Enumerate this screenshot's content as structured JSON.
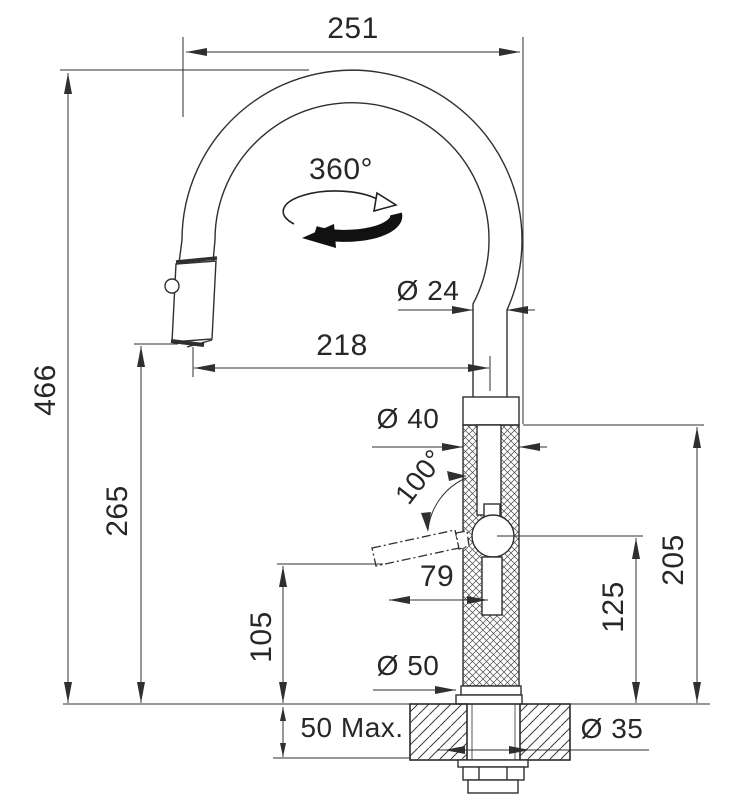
{
  "drawing": {
    "kind": "faucet-installation-dimension-diagram",
    "colors": {
      "line": "#2f2f2f",
      "background": "#ffffff",
      "knurl_texture": "#4a4a4a",
      "section_hatch": "#3d3d3d"
    },
    "icons": {
      "swivel_rotation_icon": "circular-arrow"
    }
  },
  "labels": {
    "spout_width": "251",
    "swivel_angle": "360°",
    "spout_tube_diameter": "Ø 24",
    "spout_reach": "218",
    "overall_height": "466",
    "body_diameter": "Ø 40",
    "lever_swing_angle": "100°",
    "spray_head_height": "265",
    "lever_length": "79",
    "body_height": "205",
    "lever_pivot_height": "125",
    "lever_clearance_height": "105",
    "base_diameter": "Ø 50",
    "counter_max_thickness": "50 Max.",
    "mounting_hole_diameter": "Ø 35"
  }
}
